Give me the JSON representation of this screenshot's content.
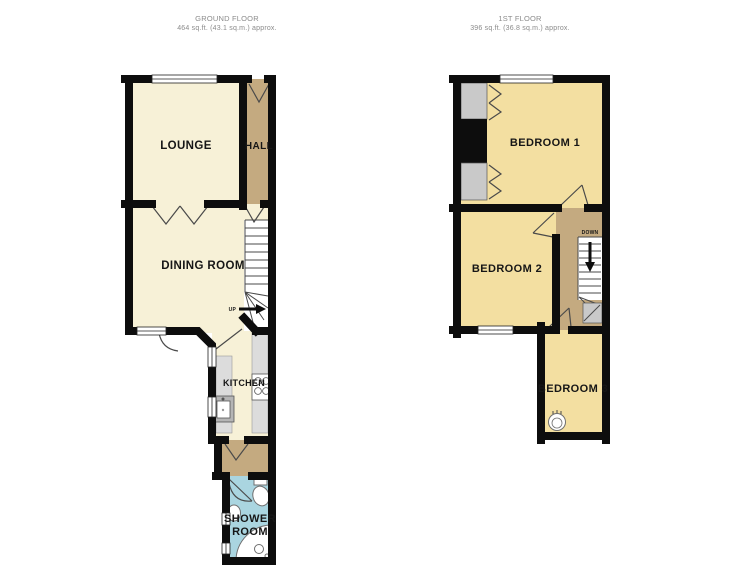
{
  "ground_floor": {
    "title": "GROUND FLOOR",
    "area": "464 sq.ft. (43.1 sq.m.) approx.",
    "rooms": {
      "lounge": "LOUNGE",
      "hall": "HALL",
      "dining_room": "DINING ROOM",
      "kitchen": "KITCHEN",
      "shower_room_line1": "SHOWER",
      "shower_room_line2": "ROOM"
    },
    "stair_label": "UP"
  },
  "first_floor": {
    "title": "1ST FLOOR",
    "area": "396 sq.ft. (36.8 sq.m.) approx.",
    "rooms": {
      "bedroom1": "BEDROOM 1",
      "bedroom2": "BEDROOM 2",
      "bedroom3": "BEDROOM 3"
    },
    "stair_label": "DOWN"
  },
  "colors": {
    "wall": "#0d0d0d",
    "cream": "#f7f1d7",
    "gold": "#f3dfa1",
    "tan": "#c4aa80",
    "blue": "#aad5e0",
    "closet_gray": "#c9c9c9",
    "counter_gray": "#dcdcdc",
    "sink_unit_gray": "#b5b5b5",
    "stairs_white": "#ffffff",
    "header_text": "#8b8b8b",
    "label_text": "#161616"
  }
}
